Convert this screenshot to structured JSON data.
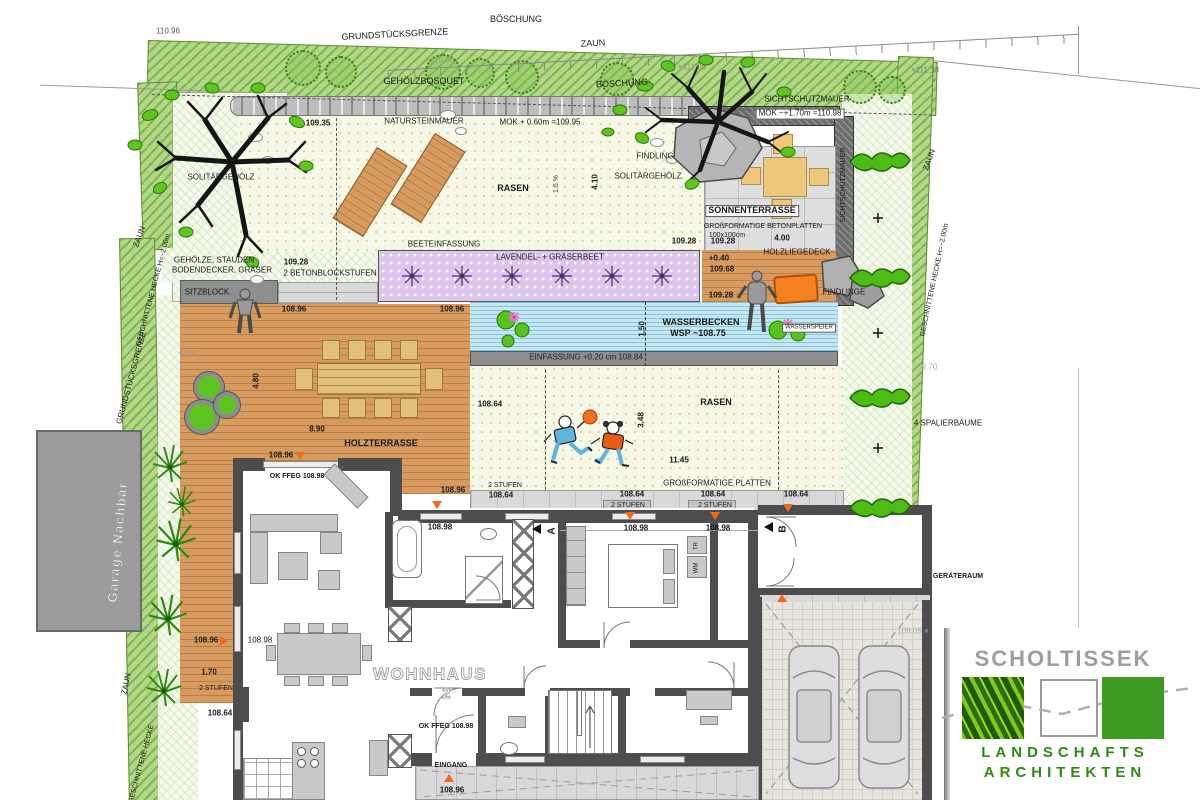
{
  "logo": {
    "title": "SCHOLTISSEK",
    "line1": "LANDSCHAFTS",
    "line2": "ARCHITEKTEN",
    "colors": {
      "gray": "#9b9da0",
      "green": "#3d9b1f"
    }
  },
  "plan": {
    "labels": [
      {
        "id": "boeschung-top",
        "t": "BÖSCHUNG",
        "x": 516,
        "y": 20,
        "s": 9
      },
      {
        "id": "grundstuecksgrenze-top",
        "t": "GRUNDSTÜCKSGRENZE",
        "x": 395,
        "y": 35,
        "s": 9,
        "r": -3
      },
      {
        "id": "zaun-top",
        "t": "ZAUN",
        "x": 593,
        "y": 44,
        "s": 9,
        "r": -3
      },
      {
        "id": "hoehe-110-96-left",
        "t": "110.96",
        "x": 168,
        "y": 32,
        "c": "#555"
      },
      {
        "id": "hoehe-110-96-mid",
        "t": "×110.96",
        "x": 440,
        "y": 61,
        "c": "#95a86f"
      },
      {
        "id": "gehoelzbosquet",
        "t": "GEHÖLZBOSQUET",
        "x": 424,
        "y": 82,
        "s": 9
      },
      {
        "id": "boeschung-mid",
        "t": "BÖSCHUNG",
        "x": 622,
        "y": 84,
        "s": 9,
        "r": -3
      },
      {
        "id": "hoehe-111-05",
        "t": "×111.05",
        "x": 692,
        "y": 68,
        "c": "#8a9a78"
      },
      {
        "id": "hoehe-111-13",
        "t": "×111.13",
        "x": 925,
        "y": 71,
        "c": "#777"
      },
      {
        "id": "hoehe-109-35",
        "t": "109.35",
        "x": 318,
        "y": 124,
        "b": 1
      },
      {
        "id": "natursteinmauer",
        "t": "NATURSTEINMAUER",
        "x": 424,
        "y": 122
      },
      {
        "id": "mok-060",
        "t": "MOK + 0.60m =109.95",
        "x": 540,
        "y": 123
      },
      {
        "id": "rasen-upper",
        "t": "RASEN",
        "x": 513,
        "y": 189,
        "b": 1,
        "s": 9
      },
      {
        "id": "slope-15",
        "t": "1.5 %",
        "x": 557,
        "y": 184,
        "r": -90,
        "s": 7,
        "c": "#444"
      },
      {
        "id": "dim-4-10",
        "t": "4.10",
        "x": 596,
        "y": 182,
        "r": -90,
        "b": 1
      },
      {
        "id": "findling",
        "t": "FINDLING",
        "x": 655,
        "y": 157
      },
      {
        "id": "solitaergehoelz-right",
        "t": "SOLITÄRGEHÖLZ",
        "x": 648,
        "y": 177
      },
      {
        "id": "solitaergehoelz-left",
        "t": "SOLITÄRGEHÖLZ",
        "x": 221,
        "y": 178
      },
      {
        "id": "sichtschutzmauer-top",
        "t": "SICHTSCHUTZMAUER",
        "x": 807,
        "y": 100
      },
      {
        "id": "mok-170",
        "t": "MOK ~+1.70m =110.98",
        "x": 800,
        "y": 114,
        "bg": 1
      },
      {
        "id": "sonnenterrasse",
        "t": "SONNENTERRASSE",
        "x": 752,
        "y": 211,
        "b": 1,
        "s": 9,
        "bg": 1
      },
      {
        "id": "betonplatten",
        "t": "GROßFORMATIGE BETONPLATTEN",
        "x": 763,
        "y": 227,
        "s": 7
      },
      {
        "id": "betonplatten-size",
        "t": "100x100cm",
        "x": 727,
        "y": 236,
        "s": 7
      },
      {
        "id": "hoehe-109-28-a",
        "t": "109.28",
        "x": 684,
        "y": 242,
        "b": 1
      },
      {
        "id": "hoehe-109-28-b",
        "t": "109.28",
        "x": 723,
        "y": 242,
        "b": 1
      },
      {
        "id": "dim-4-00",
        "t": "4.00",
        "x": 782,
        "y": 239,
        "b": 1
      },
      {
        "id": "sichtschutzmauer-right",
        "t": "SICHTSCHUTZMAUER",
        "x": 844,
        "y": 185,
        "r": -90,
        "s": 7
      },
      {
        "id": "beeteinfassung",
        "t": "BEETEINFASSUNG",
        "x": 444,
        "y": 245
      },
      {
        "id": "gehoelze-stauden",
        "t": "GEHÖLZE, STAUDEN",
        "x": 214,
        "y": 261
      },
      {
        "id": "bodendecker",
        "t": "BODENDECKER, GRÄSER",
        "x": 222,
        "y": 271
      },
      {
        "id": "hoehe-109-28-c",
        "t": "109.28",
        "x": 296,
        "y": 263,
        "b": 1
      },
      {
        "id": "betonblockstufen",
        "t": "2 BETONBLOCKSTUFEN",
        "x": 330,
        "y": 274
      },
      {
        "id": "sitzblock",
        "t": "SITZBLOCK",
        "x": 207,
        "y": 293
      },
      {
        "id": "hoehe-108-96-a",
        "t": "108.96",
        "x": 294,
        "y": 310,
        "b": 1
      },
      {
        "id": "hoehe-108-96-b",
        "t": "108.96",
        "x": 452,
        "y": 310,
        "b": 1
      },
      {
        "id": "lavendel",
        "t": "LAVENDEL- + GRÄSERBEET",
        "x": 550,
        "y": 258
      },
      {
        "id": "plus-0-40",
        "t": "+0.40",
        "x": 719,
        "y": 259,
        "b": 1
      },
      {
        "id": "hoehe-109-68",
        "t": "109.68",
        "x": 722,
        "y": 270,
        "b": 1
      },
      {
        "id": "holzliegedeck",
        "t": "HOLZLIEGEDECK",
        "x": 797,
        "y": 253
      },
      {
        "id": "hoehe-109-28-d",
        "t": "109.28",
        "x": 721,
        "y": 296,
        "b": 1
      },
      {
        "id": "findlinge",
        "t": "FINDLINGE",
        "x": 844,
        "y": 293
      },
      {
        "id": "wasserbecken",
        "t": "WASSERBECKEN",
        "x": 701,
        "y": 323,
        "b": 1,
        "s": 9
      },
      {
        "id": "wsp",
        "t": "WSP ~108.75",
        "x": 698,
        "y": 334,
        "b": 1,
        "s": 9
      },
      {
        "id": "dim-1-50",
        "t": "1.50",
        "x": 643,
        "y": 329,
        "r": -90,
        "b": 1
      },
      {
        "id": "wasserspeier",
        "t": "WASSERSPEIER",
        "x": 809,
        "y": 328,
        "s": 6,
        "bg": 1
      },
      {
        "id": "einfassung",
        "t": "EINFASSUNG +0.20 cm 108.84",
        "x": 586,
        "y": 358,
        "c": "#222"
      },
      {
        "id": "dim-9-94",
        "t": "9.94",
        "x": 187,
        "y": 355,
        "c": "#999"
      },
      {
        "id": "dim-4-80",
        "t": "4.80",
        "x": 257,
        "y": 381,
        "r": -90,
        "b": 1
      },
      {
        "id": "dim-8-90",
        "t": "8.90",
        "x": 317,
        "y": 430,
        "b": 1
      },
      {
        "id": "holzterrasse",
        "t": "HOLZTERRASSE",
        "x": 381,
        "y": 444,
        "b": 1,
        "s": 9
      },
      {
        "id": "hoehe-108-96-c",
        "t": "108.96",
        "x": 281,
        "y": 456,
        "b": 1
      },
      {
        "id": "ok-ffeg-a",
        "t": "OK FFEG 108.98",
        "x": 297,
        "y": 477,
        "b": 1,
        "s": 7
      },
      {
        "id": "hoehe-108-96-d",
        "t": "108.96",
        "x": 453,
        "y": 491,
        "b": 1
      },
      {
        "id": "hoehe-108-64-a",
        "t": "108.64",
        "x": 490,
        "y": 405,
        "b": 1
      },
      {
        "id": "rasen-lower",
        "t": "RASEN",
        "x": 716,
        "y": 403,
        "b": 1,
        "s": 9
      },
      {
        "id": "dim-3-48",
        "t": "3.48",
        "x": 642,
        "y": 420,
        "r": -90,
        "b": 1
      },
      {
        "id": "dim-11-45",
        "t": "11.45",
        "x": 679,
        "y": 461,
        "b": 1
      },
      {
        "id": "stufen-a",
        "t": "2 STUFEN",
        "x": 505,
        "y": 486,
        "s": 7
      },
      {
        "id": "hoehe-108-64-b",
        "t": "108.64",
        "x": 501,
        "y": 496,
        "b": 1
      },
      {
        "id": "grossformatige-platten",
        "t": "GROßFORMATIGE PLATTEN",
        "x": 717,
        "y": 484
      },
      {
        "id": "hoehe-108-64-c",
        "t": "108.64",
        "x": 632,
        "y": 495,
        "b": 1
      },
      {
        "id": "stufen-b",
        "t": "2 STUFEN",
        "x": 628,
        "y": 506,
        "s": 7
      },
      {
        "id": "hoehe-108-64-d",
        "t": "108.64",
        "x": 713,
        "y": 495,
        "b": 1
      },
      {
        "id": "stufen-c",
        "t": "2 STUFEN",
        "x": 715,
        "y": 506,
        "s": 7
      },
      {
        "id": "hoehe-108-64-e",
        "t": "108.64",
        "x": 796,
        "y": 495,
        "b": 1
      },
      {
        "id": "hoehe-108-98-a",
        "t": "108.98",
        "x": 440,
        "y": 528,
        "b": 1
      },
      {
        "id": "hoehe-108-98-b",
        "t": "108.98",
        "x": 636,
        "y": 529,
        "b": 1
      },
      {
        "id": "hoehe-108-98-c",
        "t": "108.98",
        "x": 718,
        "y": 529,
        "b": 1
      },
      {
        "id": "hoehe-108-96-e",
        "t": "108.96",
        "x": 206,
        "y": 641,
        "b": 1
      },
      {
        "id": "hoehe-108-98-d",
        "t": "108.98",
        "x": 260,
        "y": 641
      },
      {
        "id": "dim-1-70",
        "t": "1.70",
        "x": 209,
        "y": 673,
        "b": 1
      },
      {
        "id": "stufen-d",
        "t": "2 STUFEN",
        "x": 216,
        "y": 689,
        "s": 7
      },
      {
        "id": "hoehe-108-64-f",
        "t": "108.64",
        "x": 220,
        "y": 714,
        "b": 1
      },
      {
        "id": "wohnhaus",
        "t": "WOHNHAUS",
        "x": 430,
        "y": 675,
        "s": 17,
        "o": 1
      },
      {
        "id": "wohnhaus-2",
        "t": "2",
        "x": 447,
        "y": 694,
        "s": 15,
        "o": 1
      },
      {
        "id": "ok-ffeg-b",
        "t": "OK FFEG 108.98",
        "x": 446,
        "y": 727,
        "b": 1,
        "s": 7
      },
      {
        "id": "eingang",
        "t": "EINGANG",
        "x": 451,
        "y": 766,
        "b": 1,
        "s": 7
      },
      {
        "id": "hoehe-108-96-f",
        "t": "108.96",
        "x": 452,
        "y": 791,
        "b": 1
      },
      {
        "id": "geraeteraum",
        "t": "GERÄTERAUM",
        "x": 958,
        "y": 577,
        "b": 1,
        "s": 7
      },
      {
        "id": "hoehe-109-05",
        "t": "109.05 ×",
        "x": 913,
        "y": 632,
        "c": "#aaa"
      },
      {
        "id": "zaun-right",
        "t": "ZAUN",
        "x": 930,
        "y": 160,
        "r": -70
      },
      {
        "id": "hecke-right",
        "t": "GESCHNITTENE HECKE  H=~2.00m",
        "x": 935,
        "y": 280,
        "r": -78,
        "s": 7
      },
      {
        "id": "hoehe-109-70",
        "t": "109.70",
        "x": 925,
        "y": 368,
        "c": "#aaa"
      },
      {
        "id": "spalierbaeume",
        "t": "4 SPALIERBÄUME",
        "x": 948,
        "y": 424
      },
      {
        "id": "zaun-left-top",
        "t": "ZAUN",
        "x": 140,
        "y": 237,
        "r": -70
      },
      {
        "id": "hecke-left",
        "t": "GESCHNITTENE HECKE  H=~2.00m",
        "x": 154,
        "y": 290,
        "r": -75,
        "s": 7
      },
      {
        "id": "grundstuecksgrenze-left",
        "t": "GRUNDSTÜCKSGRENZE",
        "x": 132,
        "y": 378,
        "r": -75
      },
      {
        "id": "garage-nachbar",
        "t": "Garage Nachbar",
        "x": 118,
        "y": 542,
        "r": -85,
        "s": 13,
        "o": 1
      },
      {
        "id": "zaun-left-bottom",
        "t": "ZAUN",
        "x": 127,
        "y": 684,
        "r": -78
      },
      {
        "id": "hecke-left-bottom",
        "t": "GESCHNITTENE HECKE",
        "x": 142,
        "y": 764,
        "r": -75,
        "s": 7
      },
      {
        "id": "tr",
        "t": "TR",
        "x": 697,
        "y": 546,
        "r": -90,
        "s": 6
      },
      {
        "id": "wm",
        "t": "WM",
        "x": 697,
        "y": 568,
        "r": -90,
        "s": 6
      },
      {
        "id": "section-a",
        "t": "A",
        "x": 552,
        "y": 531,
        "r": -90,
        "s": 10,
        "b": 1
      },
      {
        "id": "section-b",
        "t": "B",
        "x": 783,
        "y": 529,
        "r": -90,
        "s": 10,
        "b": 1
      }
    ],
    "markers": [
      {
        "d": "dn",
        "x": 295,
        "y": 452
      },
      {
        "d": "dn",
        "x": 432,
        "y": 501
      },
      {
        "d": "dn",
        "x": 625,
        "y": 512
      },
      {
        "d": "dn",
        "x": 710,
        "y": 512
      },
      {
        "d": "dn",
        "x": 783,
        "y": 504
      },
      {
        "d": "up",
        "x": 777,
        "y": 594
      },
      {
        "d": "up",
        "x": 444,
        "y": 774
      },
      {
        "d": "rt",
        "x": 220,
        "y": 636
      },
      {
        "d": "lt",
        "x": 532,
        "y": 524
      },
      {
        "d": "lt",
        "x": 764,
        "y": 522
      }
    ]
  }
}
